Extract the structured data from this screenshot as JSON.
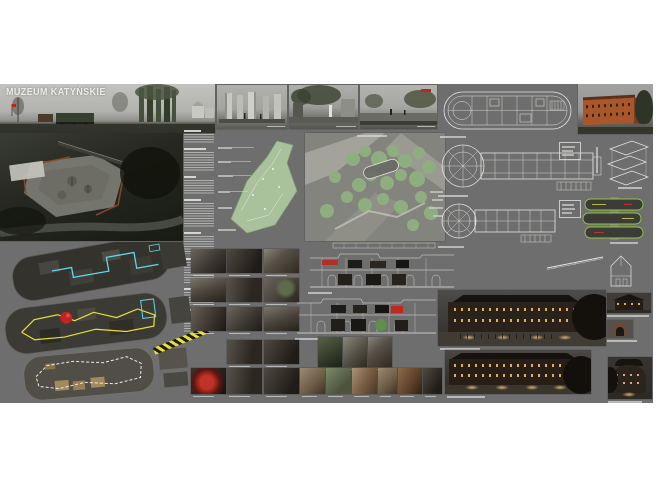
{
  "board": {
    "title": "MUZEUM KATYŃSKIE"
  },
  "colors": {
    "page_bg": "#ffffff",
    "board_bg": "#6e6e6e",
    "sky_gray": "#b7b8b4",
    "render_dark": "#22241f",
    "green_plan": "#a9c29c",
    "green_tree": "#8fae7f",
    "accent_cyan": "#5fd9e8",
    "accent_yellow": "#e8df35",
    "accent_red": "#c32320",
    "brick_day": "#a8572b",
    "brick_night": "#2a211a",
    "window_glow": "#e3b669",
    "line_white": "#e4e4e2",
    "text_gray": "#c9c9c7"
  }
}
